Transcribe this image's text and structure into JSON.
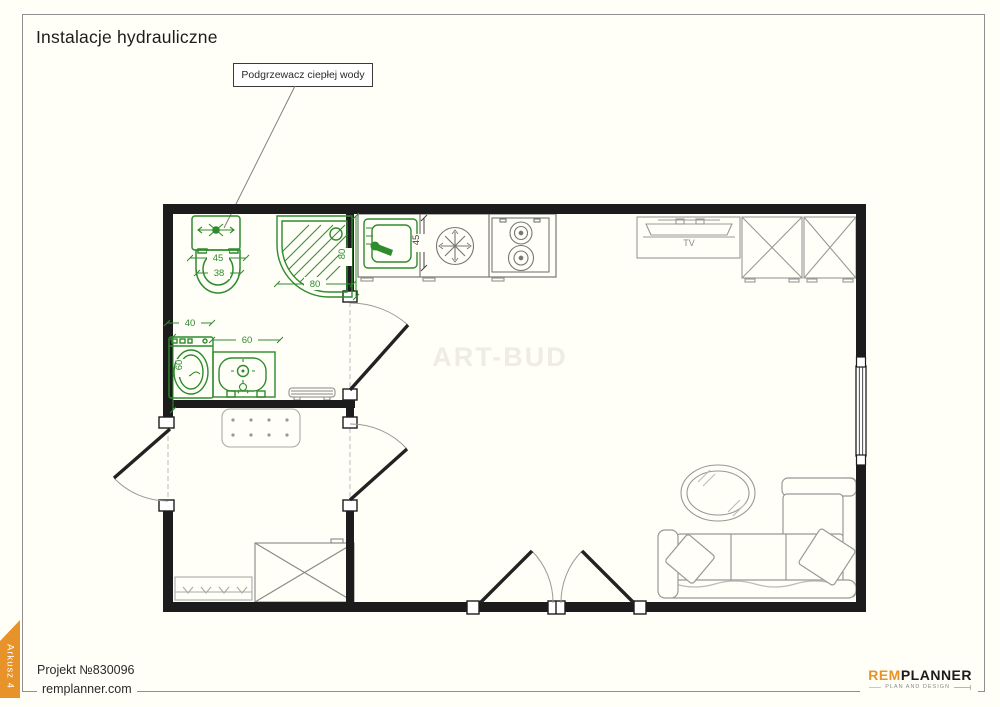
{
  "page": {
    "title": "Instalacje hydrauliczne",
    "background": "#fffef7"
  },
  "callout": {
    "label": "Podgrzewacz ciepłej wody"
  },
  "watermark": {
    "text": "ART-BUD",
    "color": "#efece4"
  },
  "sheet_tab": {
    "label": "Arkusz 4",
    "color": "#e8922a"
  },
  "footer": {
    "project": "Projekt №830096",
    "website": "remplanner.com"
  },
  "logo": {
    "rem": "REM",
    "planner": "PLANNER",
    "tagline": "PLAN AND DESIGN",
    "accent": "#e8922a"
  },
  "plan": {
    "labels": {
      "tv": "TV"
    },
    "dimensions": {
      "toilet_width": "45",
      "toilet_depth": "38",
      "shower_depth": "80",
      "shower_width": "80",
      "washer_offset": "40",
      "vanity_width": "60",
      "washer_depth": "60",
      "counter_depth": "45"
    },
    "colors": {
      "fixture_green": "#2e8b2e",
      "wall_black": "#1c1c1c",
      "furniture_gray": "#999999"
    }
  }
}
